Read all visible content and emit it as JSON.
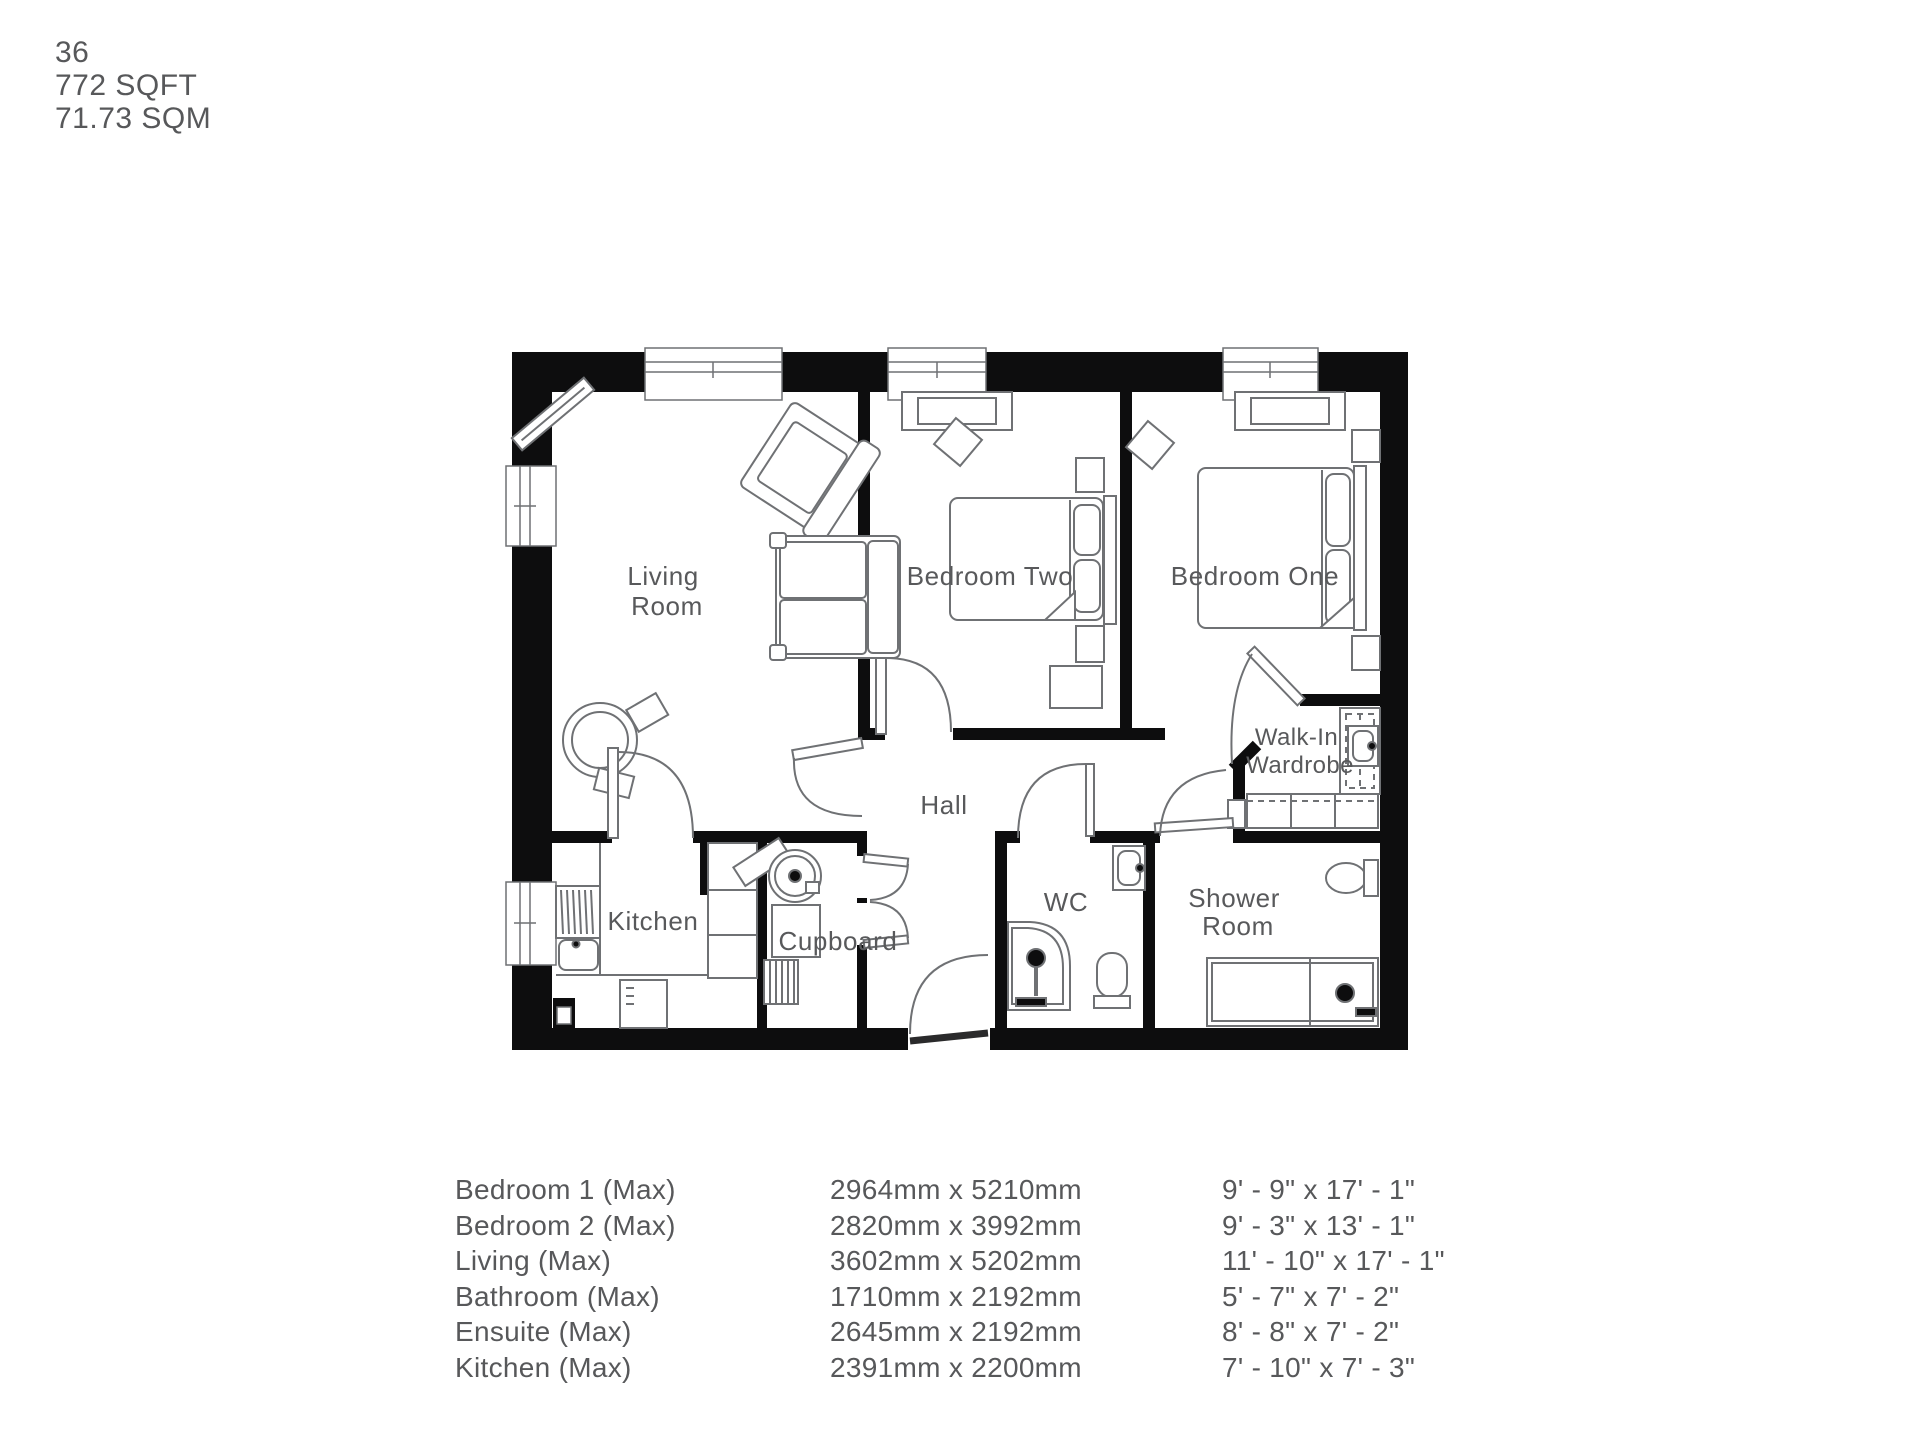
{
  "header": {
    "plot": "36",
    "sqft": "772 SQFT",
    "sqm": "71.73 SQM"
  },
  "plan": {
    "rooms": {
      "living": {
        "line1": "Living",
        "line2": "Room"
      },
      "bedroom_two": {
        "label": "Bedroom Two"
      },
      "bedroom_one": {
        "label": "Bedroom One"
      },
      "wardrobe": {
        "line1": "Walk-In",
        "line2": "Wardrobe"
      },
      "hall": {
        "label": "Hall"
      },
      "kitchen": {
        "label": "Kitchen"
      },
      "cupboard": {
        "label": "Cupboard"
      },
      "wc": {
        "label": "WC"
      },
      "shower": {
        "line1": "Shower",
        "line2": "Room"
      }
    }
  },
  "table": {
    "rows": [
      {
        "room": "Bedroom 1 (Max)",
        "metric": "2964mm x 5210mm",
        "imperial": "9' - 9\" x 17' - 1\""
      },
      {
        "room": "Bedroom 2 (Max)",
        "metric": "2820mm x 3992mm",
        "imperial": "9' - 3\" x 13' - 1\""
      },
      {
        "room": "Living (Max)",
        "metric": "3602mm x 5202mm",
        "imperial": "11' - 10\" x 17' - 1\""
      },
      {
        "room": "Bathroom (Max)",
        "metric": "1710mm x 2192mm",
        "imperial": "5' - 7\" x 7' - 2\""
      },
      {
        "room": "Ensuite (Max)",
        "metric": "2645mm x 2192mm",
        "imperial": "8' - 8\" x 7' - 2\""
      },
      {
        "room": "Kitchen (Max)",
        "metric": "2391mm x 2200mm",
        "imperial": "7' - 10\" x 7' - 3\""
      }
    ]
  },
  "colors": {
    "wall": "#0d0d0e",
    "furniture_line": "#6f7174",
    "text": "#58595b"
  }
}
